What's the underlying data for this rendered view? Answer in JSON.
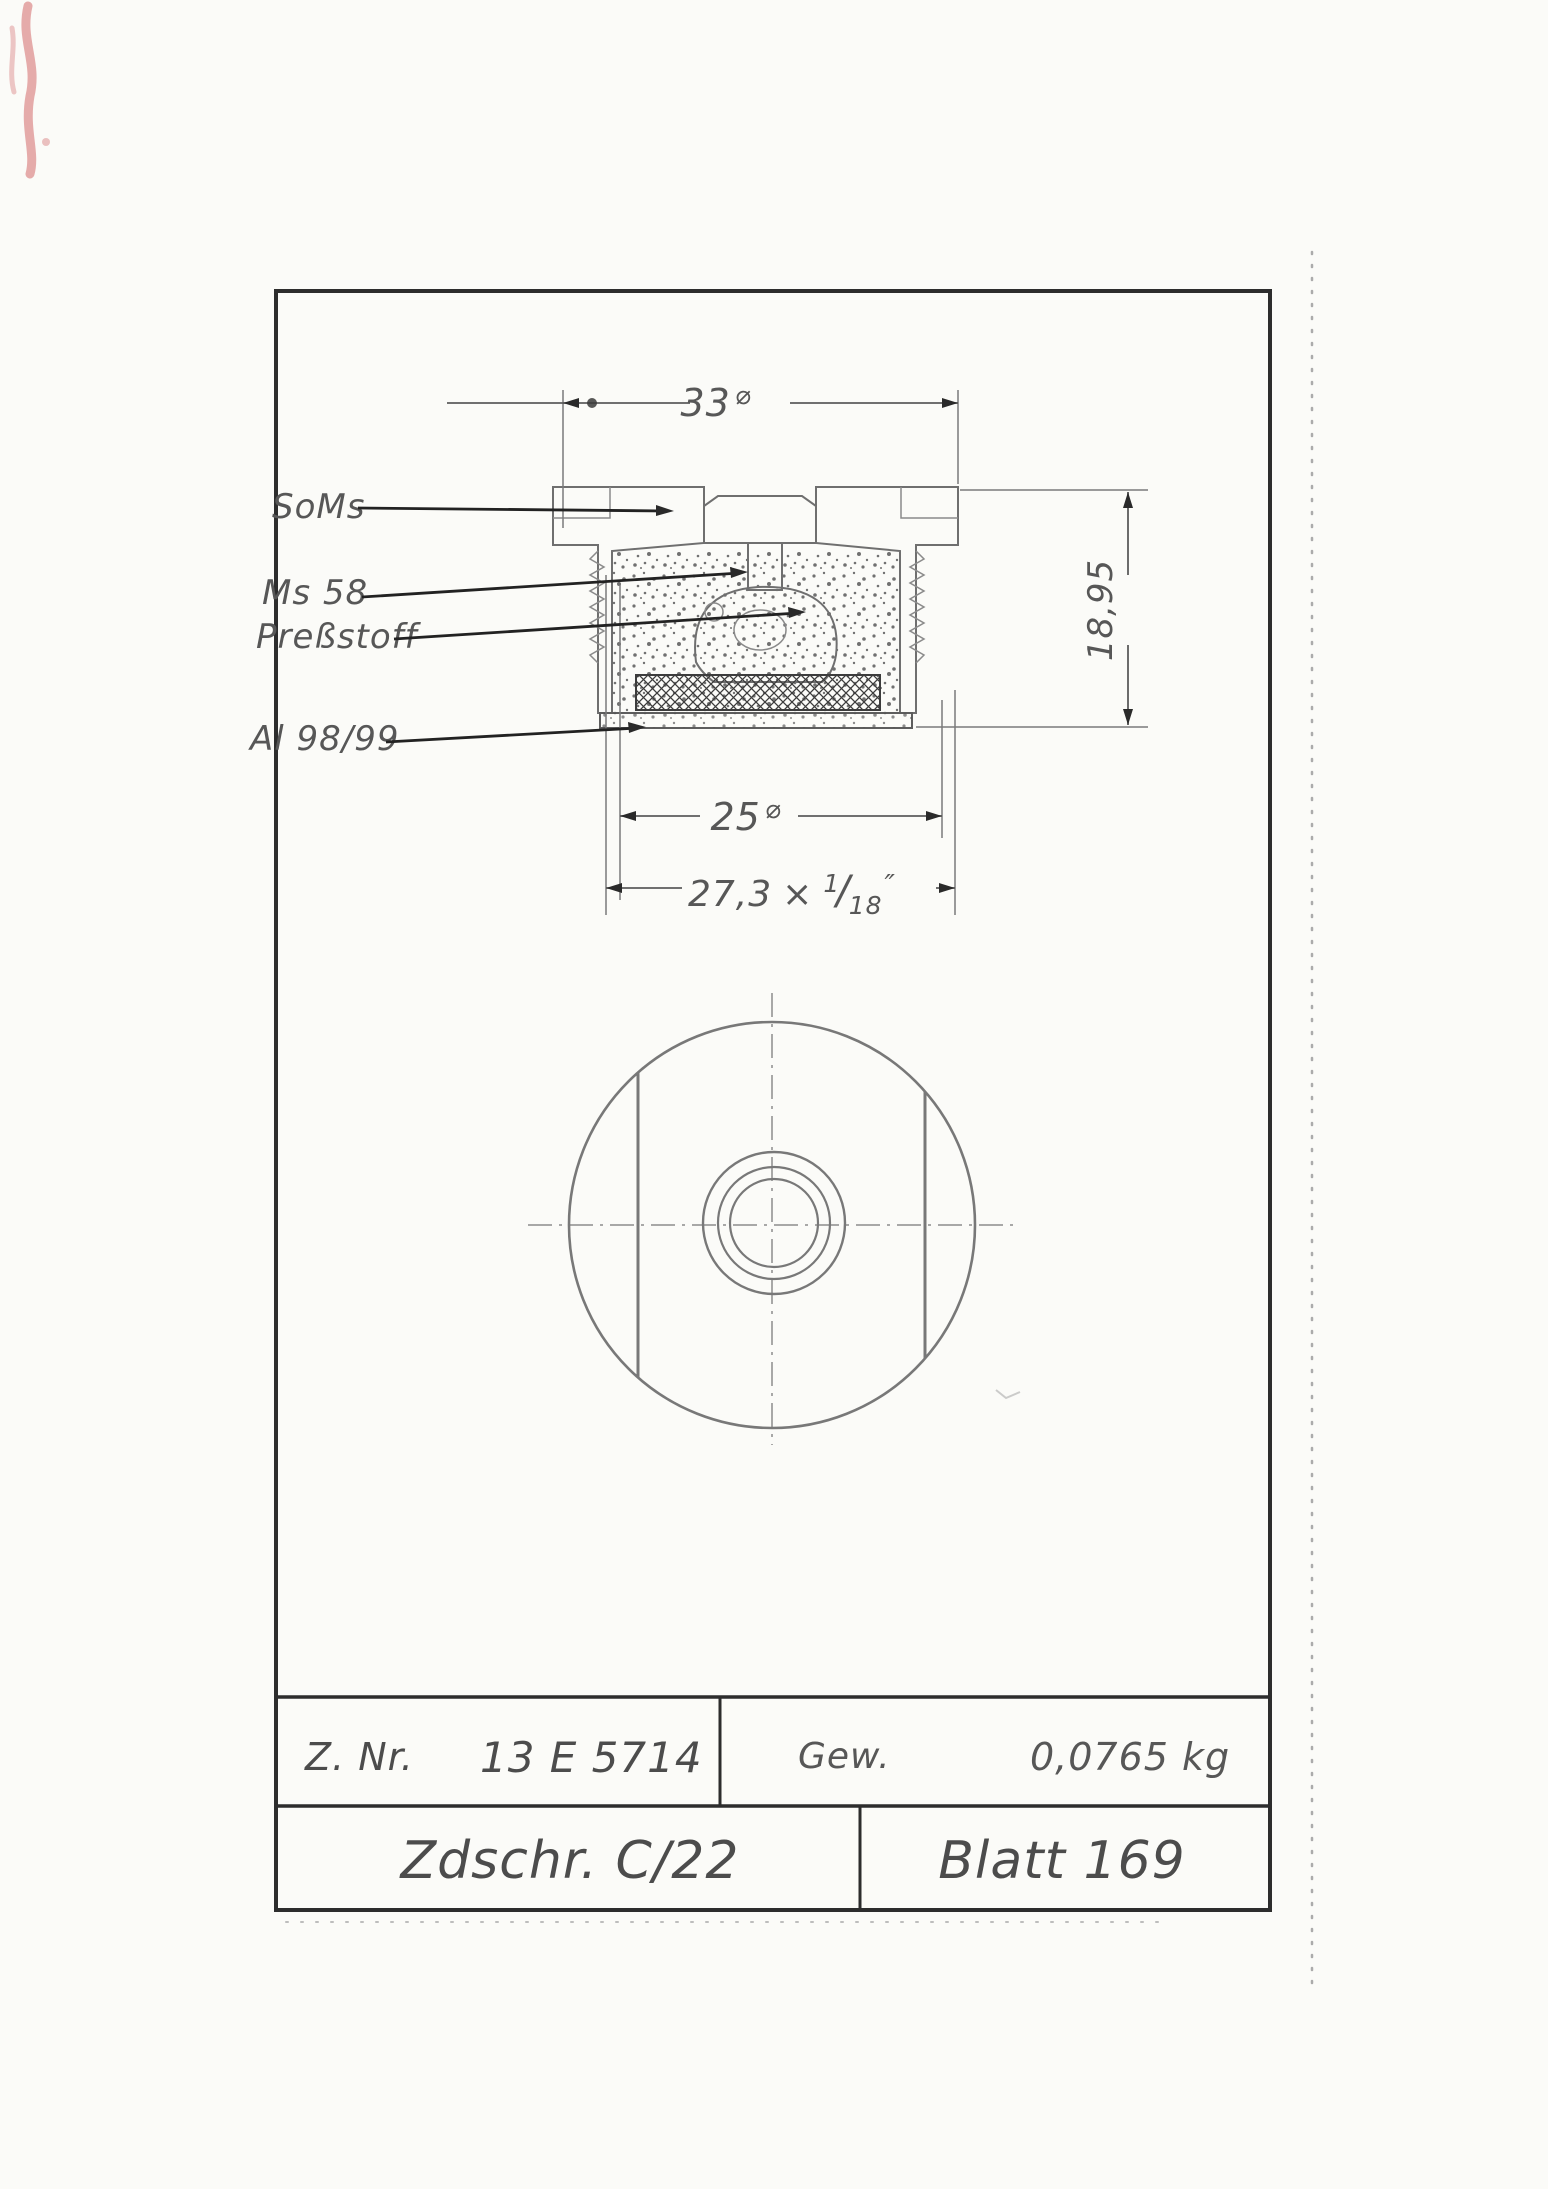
{
  "sheet": {
    "background": "#fbfbf8",
    "frame_color": "#2d2d2d",
    "line_ink": "#6f6f6f",
    "text_ink": "#575757",
    "leader_ink": "#222222",
    "red_mark": "#dd9090"
  },
  "section_view": {
    "material_labels": [
      {
        "text": "SoMs"
      },
      {
        "text": "Ms 58"
      },
      {
        "text": "Preßstoff"
      },
      {
        "text": "Al 98/99"
      }
    ],
    "dim_top": {
      "value": "33",
      "symbol": "⌀"
    },
    "dim_height": {
      "value": "18,95"
    },
    "dim_inner": {
      "value": "25",
      "symbol": "⌀"
    },
    "dim_thread": {
      "value": "27,3",
      "times": "×",
      "frac_num": "1",
      "frac_slash": "/",
      "frac_den": "18",
      "unit": "″"
    }
  },
  "title_block": {
    "znr_label": "Z. Nr.",
    "znr_value": "13 E 5714",
    "gew_label": "Gew.",
    "gew_value": "0,0765 kg",
    "zdschr_value": "Zdschr. C/22",
    "blatt_value": "Blatt 169"
  }
}
